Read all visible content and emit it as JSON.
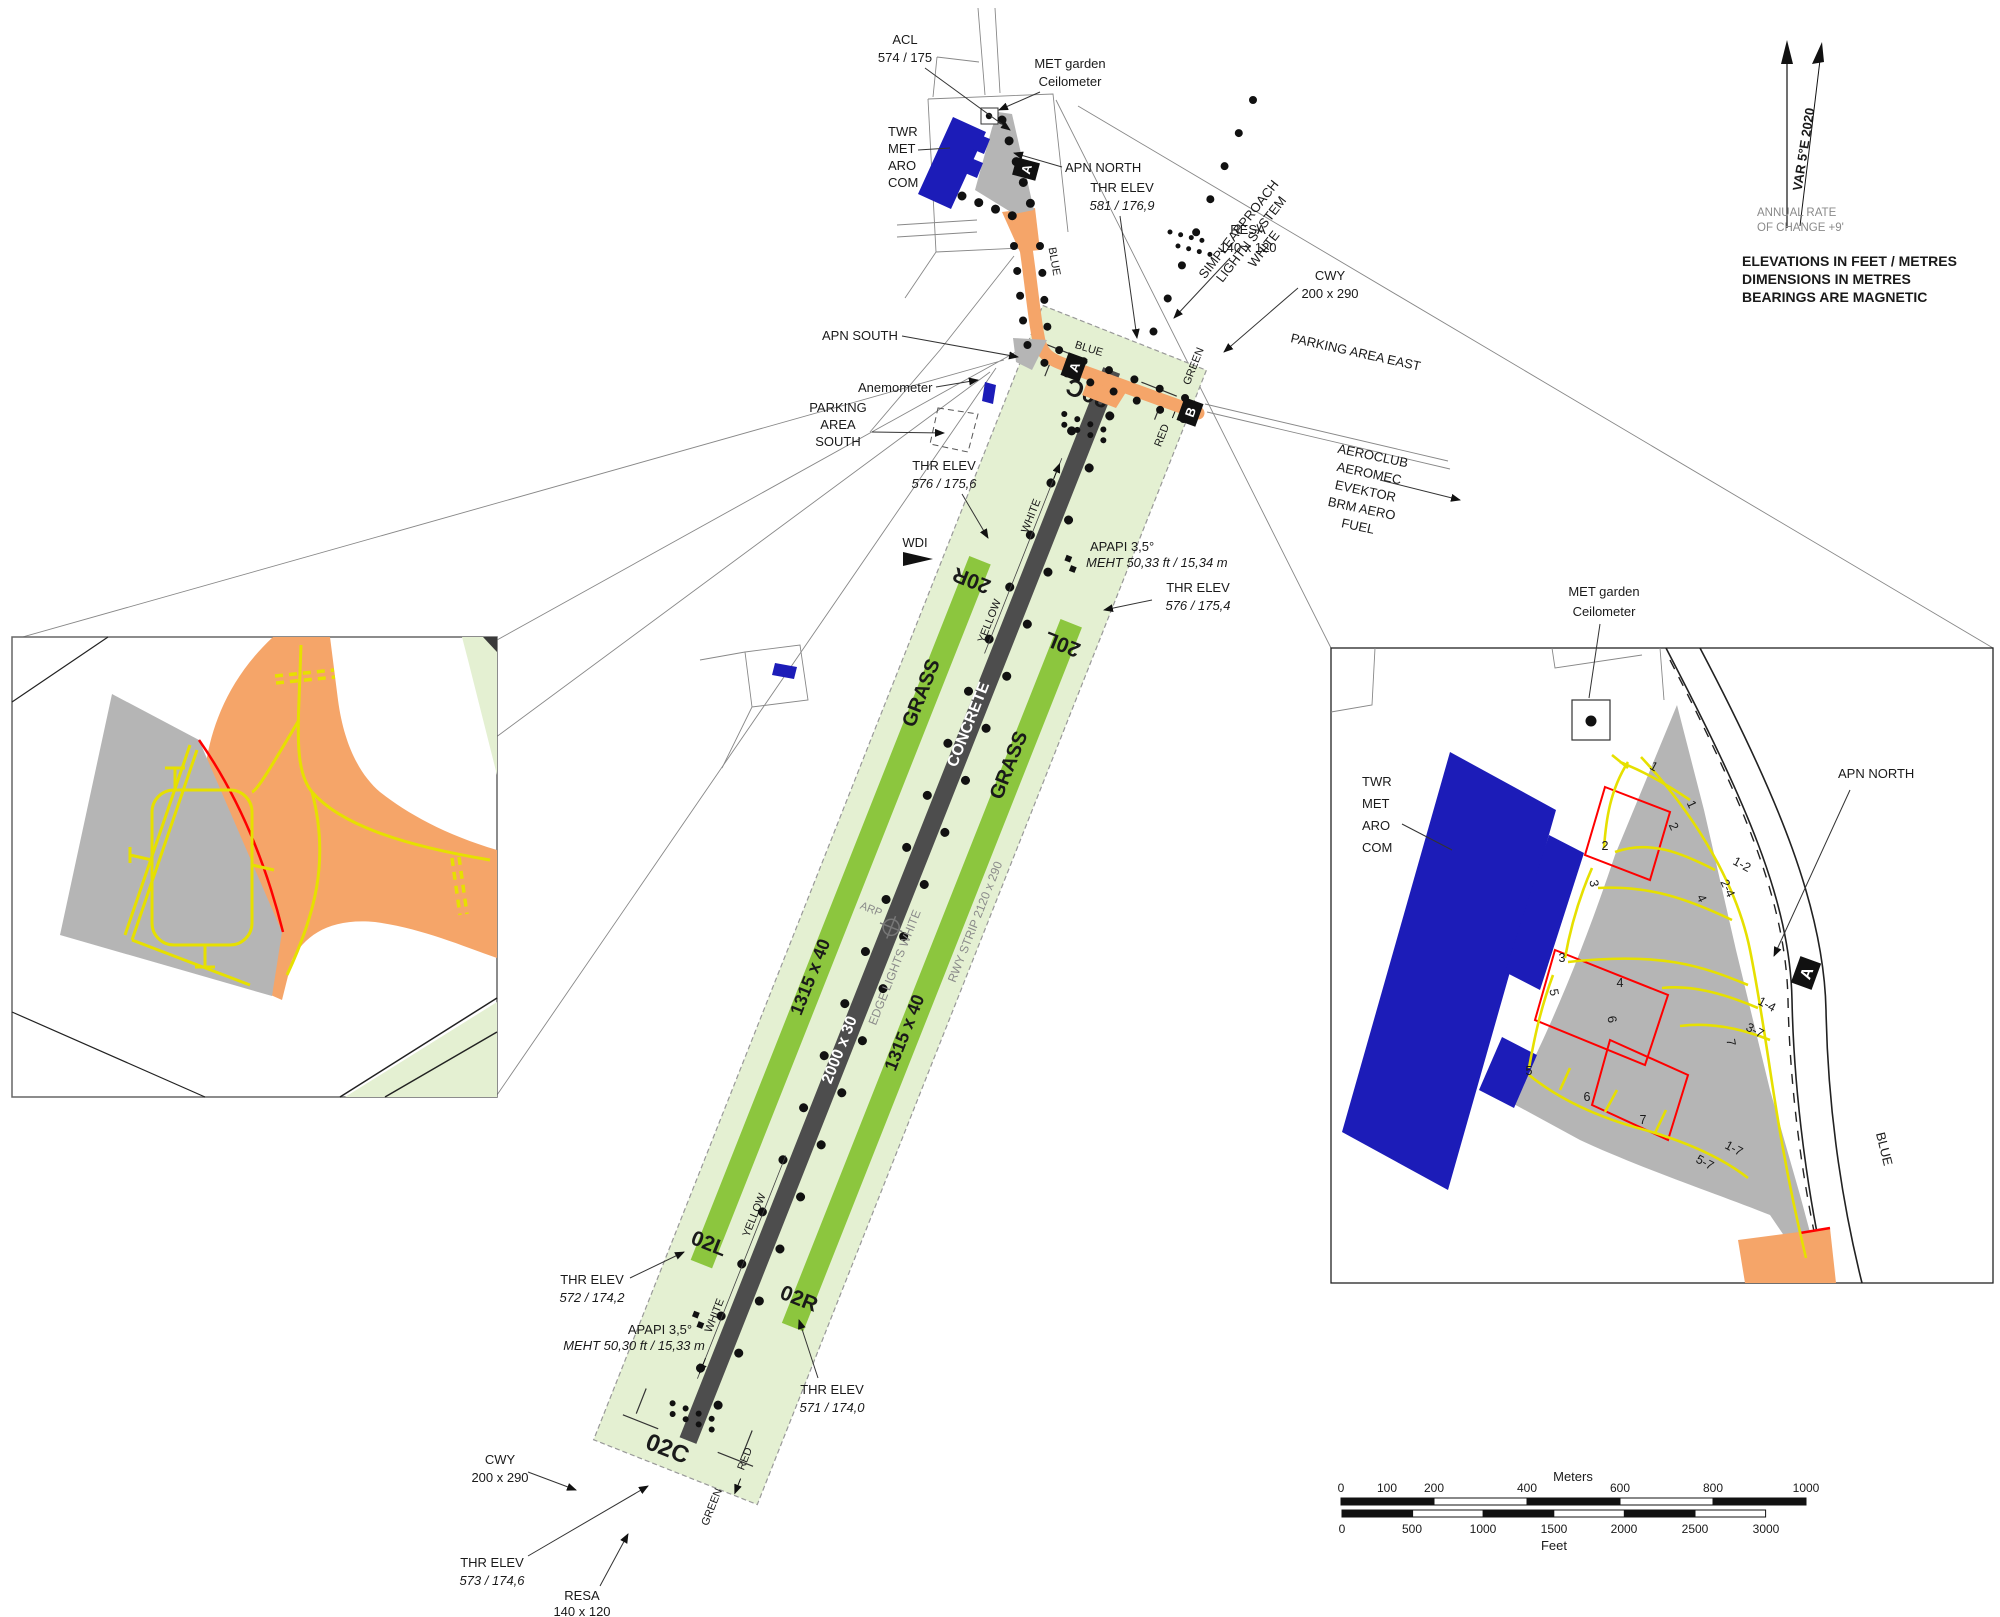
{
  "chart_title": "Aerodrome chart",
  "colors": {
    "strip_light_green": "#e4f0d2",
    "grass_runway_green": "#8cc63e",
    "concrete_runway": "#4d4d4d",
    "taxiway_orange": "#f5a569",
    "apron_gray": "#b5b5b5",
    "building_blue": "#1c1cb8",
    "marking_yellow": "#e6e000",
    "marking_red": "#ff0000",
    "muted_text_gray": "#8a8a8a"
  },
  "labels": {
    "acl1": "ACL",
    "acl2": "574 / 175",
    "met1": "MET garden",
    "met2": "Ceilometer",
    "twr1": "TWR",
    "twr2": "MET",
    "twr3": "ARO",
    "twr4": "COM",
    "apn_north": "APN NORTH",
    "apn_south": "APN SOUTH",
    "anemometer": "Anemometer",
    "pas1": "PARKING",
    "pas2": "AREA",
    "pas3": "SOUTH",
    "parking_east": "PARKING AREA EAST",
    "t1": "AEROCLUB",
    "t2": "AEROMEC",
    "t3": "EVEKTOR",
    "t4": "BRM AERO",
    "t5": "FUEL",
    "wdi": "WDI",
    "sals1": "SIMPLEAPPROACH",
    "sals2": "LIGHTN SYSTEM",
    "sals3": "WHITE",
    "thr": "THR ELEV",
    "thr_20c": "581 / 176,9",
    "thr_20r": "576 / 175,6",
    "thr_20l": "576 / 175,4",
    "thr_02l": "572 / 174,2",
    "thr_02r": "571 / 174,0",
    "thr_02c": "573 / 174,6",
    "resa": "RESA",
    "resa_dim": "140 x 120",
    "cwy": "CWY",
    "cwy_dim": "200 x 290",
    "apapi": "APAPI 3,5°",
    "meht_n": "MEHT 50,33 ft / 15,34 m",
    "meht_s": "MEHT 50,30 ft / 15,33 m"
  },
  "runway": {
    "r20c": "20C",
    "r20r": "20R",
    "r20l": "20L",
    "r02c": "02C",
    "r02l": "02L",
    "r02r": "02R",
    "grass": "GRASS",
    "concrete": "CONCRETE",
    "dim_grass": "1315 x 40",
    "dim_conc": "2000 x 30",
    "strip": "RWY STRIP 2120 x 290",
    "edge": "EDGE LIGHTS WHITE",
    "arp": "ARP"
  },
  "lights": {
    "blue": "BLUE",
    "red": "RED",
    "green": "GREEN",
    "yellow": "YELLOW",
    "white": "WHITE"
  },
  "signs": {
    "a": "A",
    "b": "B"
  },
  "north": {
    "var": "VAR 5°E 2020",
    "rate1": "ANNUAL RATE",
    "rate2": "OF CHANGE +9'",
    "note1": "ELEVATIONS IN FEET / METRES",
    "note2": "DIMENSIONS IN METRES",
    "note3": "BEARINGS ARE MAGNETIC"
  },
  "scale": {
    "meters": "Meters",
    "feet": "Feet",
    "m": [
      "0",
      "100",
      "200",
      "400",
      "600",
      "800",
      "1000"
    ],
    "ft": [
      "0",
      "500",
      "1000",
      "1500",
      "2000",
      "2500",
      "3000"
    ]
  },
  "inset": {
    "stands": {
      "s1": "1",
      "s2": "2",
      "s3": "3",
      "s4": "4",
      "s5": "5",
      "s6": "6",
      "s7": "7"
    },
    "routes": {
      "r12": "1-2",
      "r24": "2-4",
      "r14": "1-4",
      "r37": "3-7",
      "r57": "5-7",
      "r17": "1-7"
    }
  }
}
